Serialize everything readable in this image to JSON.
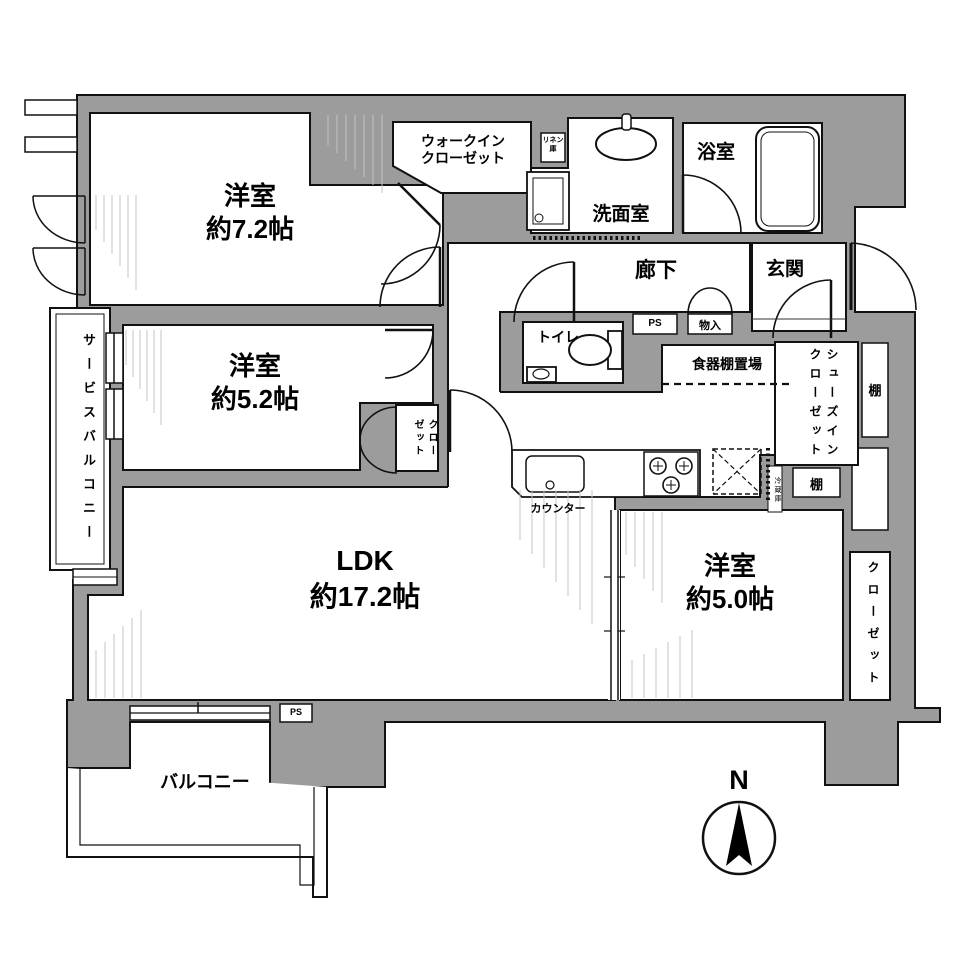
{
  "compass": {
    "label": "N"
  },
  "rooms": {
    "bedroom1": {
      "name": "洋室",
      "size": "約7.2帖"
    },
    "bedroom2": {
      "name": "洋室",
      "size": "約5.2帖"
    },
    "bedroom3": {
      "name": "洋室",
      "size": "約5.0帖"
    },
    "ldk": {
      "name": "LDK",
      "size": "約17.2帖"
    },
    "walkin_closet": {
      "line1": "ウォークイン",
      "line2": "クローゼット"
    },
    "washroom": {
      "name": "洗面室"
    },
    "bathroom": {
      "name": "浴室"
    },
    "entrance": {
      "name": "玄関"
    },
    "hallway": {
      "name": "廊下"
    },
    "toilet": {
      "name": "トイレ"
    },
    "linen": {
      "line1": "リネン",
      "line2": "庫"
    },
    "storage": {
      "name": "物入"
    },
    "ps": {
      "name": "PS"
    },
    "dish_shelf": {
      "name": "食器棚置場"
    },
    "counter": {
      "name": "カウンター"
    },
    "refrigerator": {
      "name": "冷蔵庫"
    },
    "shoe_closet": {
      "name": "シューズインクローゼット"
    },
    "shelf": {
      "name": "棚"
    },
    "closet": {
      "name": "クローゼット"
    },
    "service_balcony": {
      "name": "サービスバルコニー"
    },
    "balcony": {
      "name": "バルコニー"
    }
  },
  "colors": {
    "wall": "#9c9c9c",
    "line": "#111111",
    "hatch": "#c4c4c4"
  }
}
